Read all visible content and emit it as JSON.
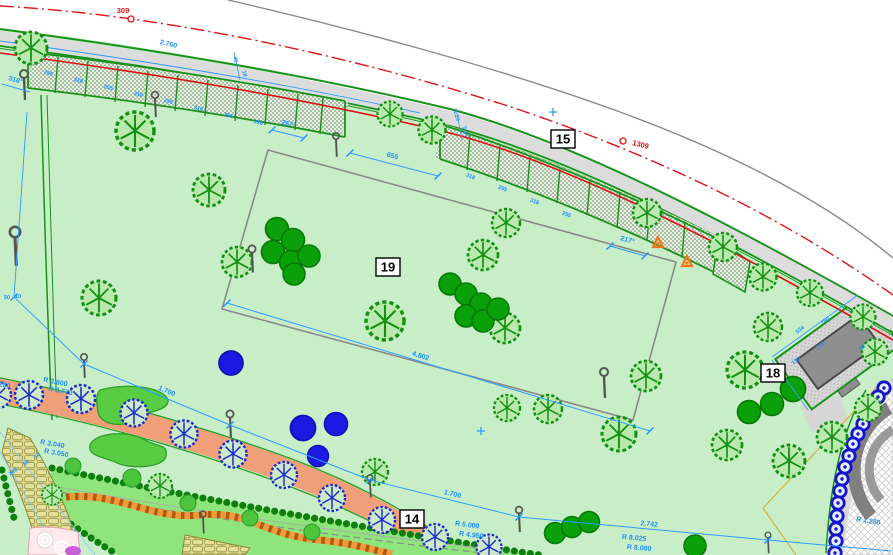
{
  "drawing": {
    "markers": {
      "left": "309",
      "right": "1309"
    },
    "labels": {
      "z15": "15",
      "z19": "19",
      "z18": "18",
      "z14": "14"
    },
    "dims": {
      "path_top": "2.760",
      "gap": "655",
      "a318": "318°",
      "a267": "267°",
      "a217": "217°",
      "field": "4.802",
      "t1700a": "1.700",
      "t1700b": "1.700",
      "t2742": "2.742",
      "r3800": "R 3.800",
      "r3770": "R 3.770",
      "r3040": "R 3.040",
      "r3050": "R 3.050",
      "r2280": "R 2.280",
      "r5000": "R 5.000",
      "r4950": "R 4.950",
      "r8025": "R 8.025",
      "r8000": "R 8.000",
      "r1280": "R 1.280",
      "off200": "200",
      "off50": "50",
      "off10": "10",
      "off50b": "50",
      "off10b": "10",
      "s534": "534",
      "s245": "245",
      "s160": "160",
      "s190": "190",
      "s60": "60",
      "v45": "45",
      "v18": "18",
      "v120": "1.20",
      "v515": "5.15",
      "panels": [
        "255",
        "318",
        "255",
        "318",
        "255",
        "318",
        "255",
        "318",
        "318",
        "255",
        "318",
        "255"
      ]
    },
    "colors": {
      "lawn": "#c8eec8",
      "play_lawn": "#8fe57b",
      "tree_fill": "#b9e9ad",
      "tree_stroke": "#129012",
      "shrub_green": "#0aa00a",
      "shrub_blue": "#1a1ae2",
      "blue_tree_stroke": "#1b2ad0",
      "walk_gray": "#dcdcdc",
      "boundary_red": "#dd1111",
      "dim_blue": "#1f8fff",
      "walk_orange": "#f0a078",
      "play_path_orange": "#f08c22",
      "stone_olive": "#ddd792",
      "building_gray": "#8f8f8f",
      "hedge_green": "#0d7f0d",
      "edge_green": "#18921a",
      "pink": "#ffe9ee",
      "purple": "#c95fd8",
      "parcel_yellow": "#d4b23a",
      "road_gray": "#8a8a8a"
    }
  }
}
